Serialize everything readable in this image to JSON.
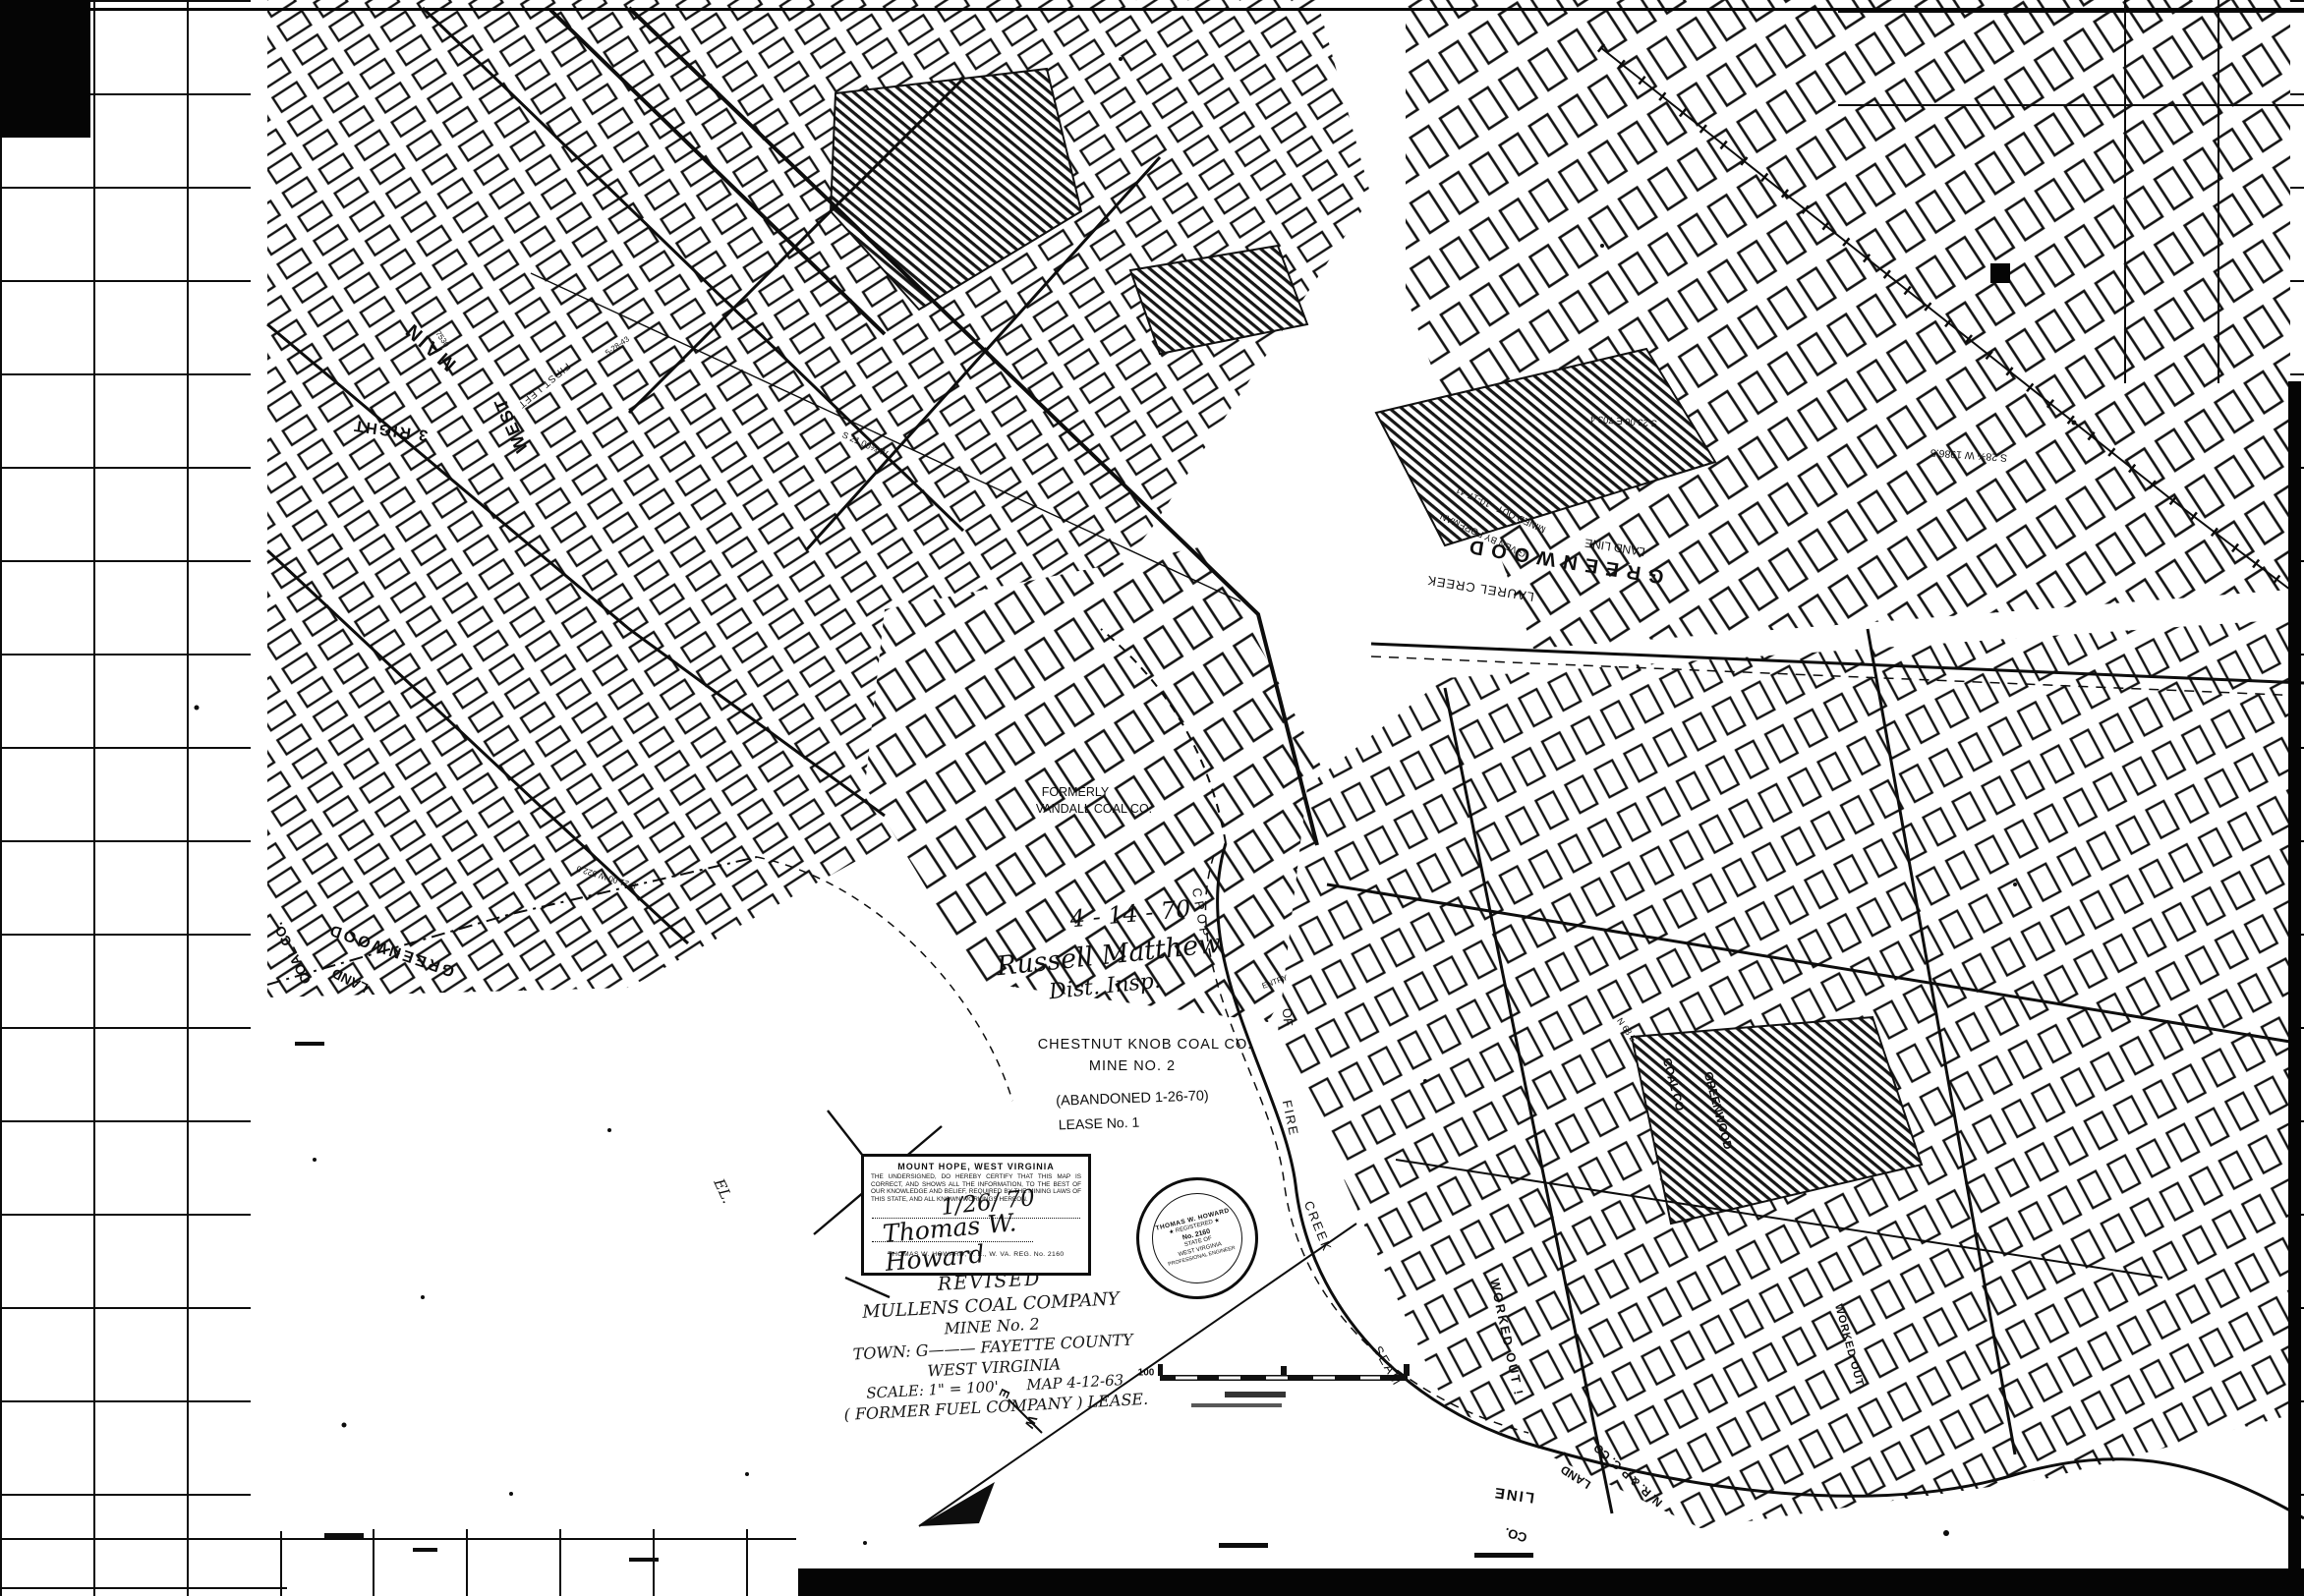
{
  "document": {
    "type": "scanned coal mine workings map",
    "ink_color": "#111111",
    "paper_color": "#ffffff"
  },
  "stamp": {
    "heading": "MOUNT HOPE, WEST VIRGINIA",
    "body": "THE UNDERSIGNED, DO HEREBY CERTIFY THAT THIS MAP IS CORRECT, AND SHOWS ALL THE INFORMATION, TO THE BEST OF OUR KNOWLEDGE AND BELIEF, REQUIRED BY THE MINING LAWS OF THIS STATE, AND ALL KNOWN WORKINGS HEREON.",
    "date": "1/26/ 70",
    "signature": "Thomas W. Howard",
    "caption": "THOMAS W. HOWARD, P. E., W. VA. REG. No. 2160"
  },
  "seal": {
    "lines": [
      "THOMAS W. HOWARD",
      "★ REGISTERED ★",
      "No. 2160",
      "STATE OF",
      "WEST VIRGINIA",
      "PROFESSIONAL ENGINEER"
    ]
  },
  "revision": {
    "lines": [
      "REVISED",
      "MULLENS COAL COMPANY",
      "MINE No. 2",
      "TOWN: G———  FAYETTE COUNTY",
      "WEST VIRGINIA",
      "SCALE: 1\" = 100'      MAP 4-12-63",
      "( FORMER  FUEL  COMPANY )  LEASE."
    ]
  },
  "labels": [
    "MAIN",
    "WEST",
    "3 RIGHT",
    "FIRST LEFT",
    "5-28-43",
    "7530",
    "FORMERLY",
    "VANDALL COAL CO.",
    "4 - 14 - 70",
    "Russell Matthew",
    "Dist. Insp.",
    "CHESTNUT KNOB COAL CO.",
    "MINE NO. 2",
    "(ABANDONED 1-26-70)",
    "LEASE No. 1",
    "ENTRY",
    "CROP",
    "OF",
    "FIRE",
    "CREEK",
    "SEAM",
    "GREENWOOD",
    "LAND",
    "COAL CO.",
    "S 21.00 W  522.0",
    "S 21.00¾ W",
    "MINED OUT - 10-17-41",
    "GIVEN BY FOREMAN",
    "GREENWOOD",
    "LAND LINE",
    "LAUREL CREEK",
    "S 28¾ W  1986.5",
    "S 23.00 E  703.4",
    "N 68 E",
    "COAL CO.",
    "GREENWOOD",
    "WORKED OUT !",
    "WORKED OUT",
    "N. R. & P. C. CO.",
    "LAND",
    "LINE",
    "CO.",
    "EL.",
    "100",
    "E",
    "W"
  ]
}
